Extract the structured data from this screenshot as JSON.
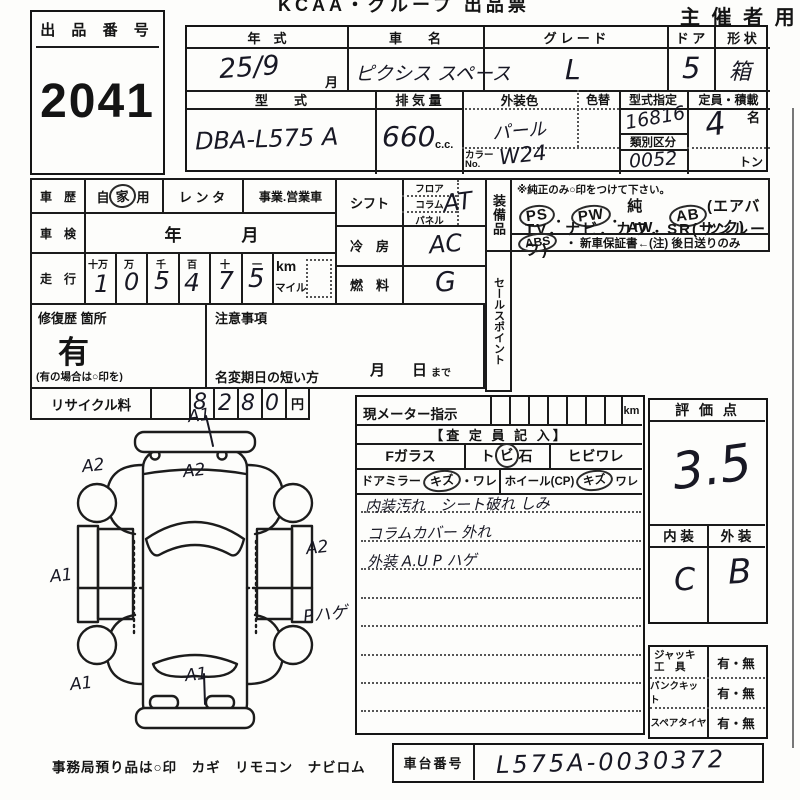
{
  "sheet": {
    "title": "KCAA・グループ 出品票",
    "audience": "主 催 者 用",
    "office_note": "事務局預り品は○印　カギ　リモコン　ナビロム"
  },
  "auction_no": {
    "label": "出 品 番 号",
    "value": "2041"
  },
  "top": {
    "year": {
      "label": "年　式",
      "value": "25/9",
      "suffix": "月"
    },
    "name": {
      "label": "車　　名",
      "value": "ピクシス スペース"
    },
    "grade": {
      "label": "グ レ ー ド",
      "value": "L"
    },
    "doors": {
      "label": "ド ア",
      "value": "5"
    },
    "shape": {
      "label": "形 状",
      "value": "箱"
    },
    "model": {
      "label": "型　　式",
      "value": "DBA-L575 A"
    },
    "disp": {
      "label": "排 気 量",
      "value": "660",
      "unit": "c.c."
    },
    "color": {
      "label": "外装色",
      "value": "パール",
      "no_label": "カラー",
      "no_label2": "No.",
      "no_value": "W24",
      "recolor_label": "色替"
    },
    "type_no": {
      "label": "型式指定",
      "value": "16816",
      "class_label": "類別区分",
      "class_value": "0052"
    },
    "capacity": {
      "label": "定員・積載",
      "value": "4",
      "unit": "名",
      "ton": "トン"
    }
  },
  "history": {
    "label": "車　歴",
    "opt1_pre": "自",
    "opt1_circle": "家",
    "opt1_post": "用",
    "opt2": "レ ン タ",
    "opt3": "事業.営業車"
  },
  "inspection": {
    "label": "車　検",
    "year": "年",
    "month": "月"
  },
  "mileage": {
    "label": "走　行",
    "cols": [
      {
        "h": "十万",
        "d": "1"
      },
      {
        "h": "万",
        "d": "0"
      },
      {
        "h": "千",
        "d": "5"
      },
      {
        "h": "百",
        "d": "4"
      },
      {
        "h": "十",
        "d": "7"
      },
      {
        "h": "一",
        "d": "5"
      }
    ],
    "km": "km",
    "mile": "マイル"
  },
  "repair": {
    "label": "修復歴 箇所",
    "value": "有",
    "note": "(有の場合は○印を)"
  },
  "caution": {
    "label": "注意事項",
    "transfer": "名変期日の短い方",
    "month": "月",
    "day": "日",
    "until": "まで"
  },
  "shift": {
    "label": "シフト",
    "sub1": "フロア",
    "sub2": "コラム",
    "sub3": "パネル",
    "value": "AT"
  },
  "aircon": {
    "label": "冷　房",
    "value": "AC"
  },
  "fuel": {
    "label": "燃　料",
    "value": "G"
  },
  "equipment": {
    "label": "装備品",
    "note": "※純正のみ○印をつけて下さい。",
    "ps": "PS",
    "sep1": "．",
    "pw": "PW",
    "sep2": "．",
    "aw": "純AW．",
    "ab": "AB",
    "airbag": "(エアバック)",
    "line2": "TV．ナビ．カワ．SR(サンルーフ)",
    "abs": "ABS",
    "line3_rest": "・ 新車保証書←(注) 後日送りのみ"
  },
  "sales_point": {
    "label": "セールスポイント"
  },
  "recycle": {
    "label": "リサイクル料",
    "d1": "8",
    "d2": "2",
    "d3": "8",
    "d4": "0",
    "unit": "円"
  },
  "meter": {
    "label": "現メーター指示",
    "unit": "km"
  },
  "assessor": {
    "header": "【査 定 員 記 入】",
    "fglass": "Fガラス",
    "stone_pre": "ト",
    "stone_circle": "ビ",
    "stone_post": "石",
    "crack": "ヒビワレ",
    "mirror_label": "ドアミラー",
    "mirror_circle": "キズ",
    "mirror_rest": "・ワレ",
    "wheel_label": "ホイール(CP)",
    "wheel_circle": "キズ",
    "wheel_rest": "ワレ",
    "note1": "内装汚れ　シート破れ しみ",
    "note2": "コラムカバー 外れ",
    "note3": "外装 A.U P ハゲ"
  },
  "score": {
    "label": "評 価 点",
    "value": "3.5"
  },
  "in_ex": {
    "in_label": "内 装",
    "ex_label": "外 装",
    "in_value": "C",
    "ex_value": "B"
  },
  "tools": {
    "row1_label_a": "ジャッキ",
    "row1_label_b": "工　具",
    "row1_value": "有・無",
    "row2_label": "パンクキット",
    "row2_value": "有・無",
    "row3_label": "スペアタイヤ",
    "row3_value": "有・無"
  },
  "chassis": {
    "label": "車台番号",
    "value": "L575A-0030372"
  },
  "diagram": {
    "marks": [
      {
        "label": "A1",
        "x": 188,
        "y": 406
      },
      {
        "label": "A2",
        "x": 82,
        "y": 456
      },
      {
        "label": "A2",
        "x": 183,
        "y": 461
      },
      {
        "label": "A1",
        "x": 50,
        "y": 566
      },
      {
        "label": "A2",
        "x": 306,
        "y": 538
      },
      {
        "label": "Pハゲ",
        "x": 303,
        "y": 600
      },
      {
        "label": "A1",
        "x": 70,
        "y": 674
      },
      {
        "label": "A1",
        "x": 185,
        "y": 665
      }
    ]
  }
}
